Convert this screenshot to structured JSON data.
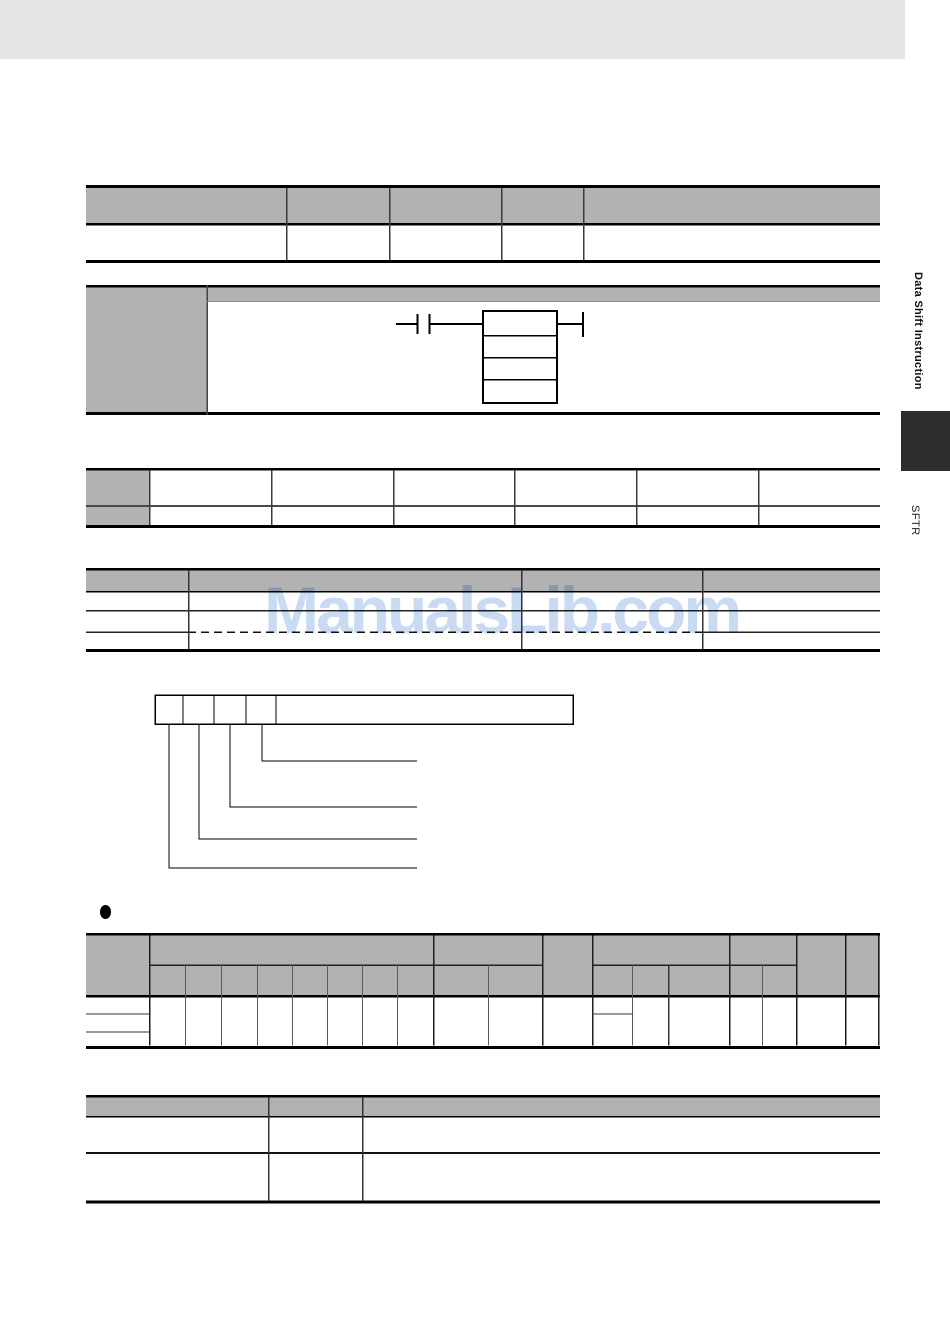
{
  "document": {
    "kind": "plc-manual-page",
    "side_tab": {
      "section_title": "Data Shift Instruction",
      "instruction_code": "SFTR",
      "marker_color": "#2d2d2d"
    },
    "watermark": {
      "text": "ManualsLib.com",
      "color": "#c9daf3"
    },
    "bullet_glyph": "●",
    "colors": {
      "page_background": "#ffffff",
      "top_banner": "#e6e6e6",
      "table_header_gray": "#b2b2b2",
      "border_dark": "#000000",
      "border_light": "#555555"
    },
    "tables": [
      {
        "name": "summary-table",
        "header_rows": 1,
        "body_rows": 1,
        "columns": 5,
        "cells_text": []
      },
      {
        "name": "ladder-symbol-panel",
        "description": "condition contact feeding a 4-row instruction block with right-side terminal",
        "cells_text": []
      },
      {
        "name": "applicable-areas-table",
        "rows": 2,
        "columns": 7,
        "cells_text": []
      },
      {
        "name": "operand-limits-table",
        "header_rows": 1,
        "body_rows": 3,
        "columns": 4,
        "cells_text": []
      },
      {
        "name": "control-word-bit-diagram",
        "small_cells": 4,
        "callout_lines": 4,
        "cells_text": []
      },
      {
        "name": "operand-specifications-table",
        "header_rows": 2,
        "body_rows": 1,
        "column_groups": 5,
        "leaf_columns": 16,
        "cells_text": []
      },
      {
        "name": "flags-table",
        "header_rows": 1,
        "body_rows": 2,
        "columns": 3,
        "cells_text": []
      }
    ]
  }
}
